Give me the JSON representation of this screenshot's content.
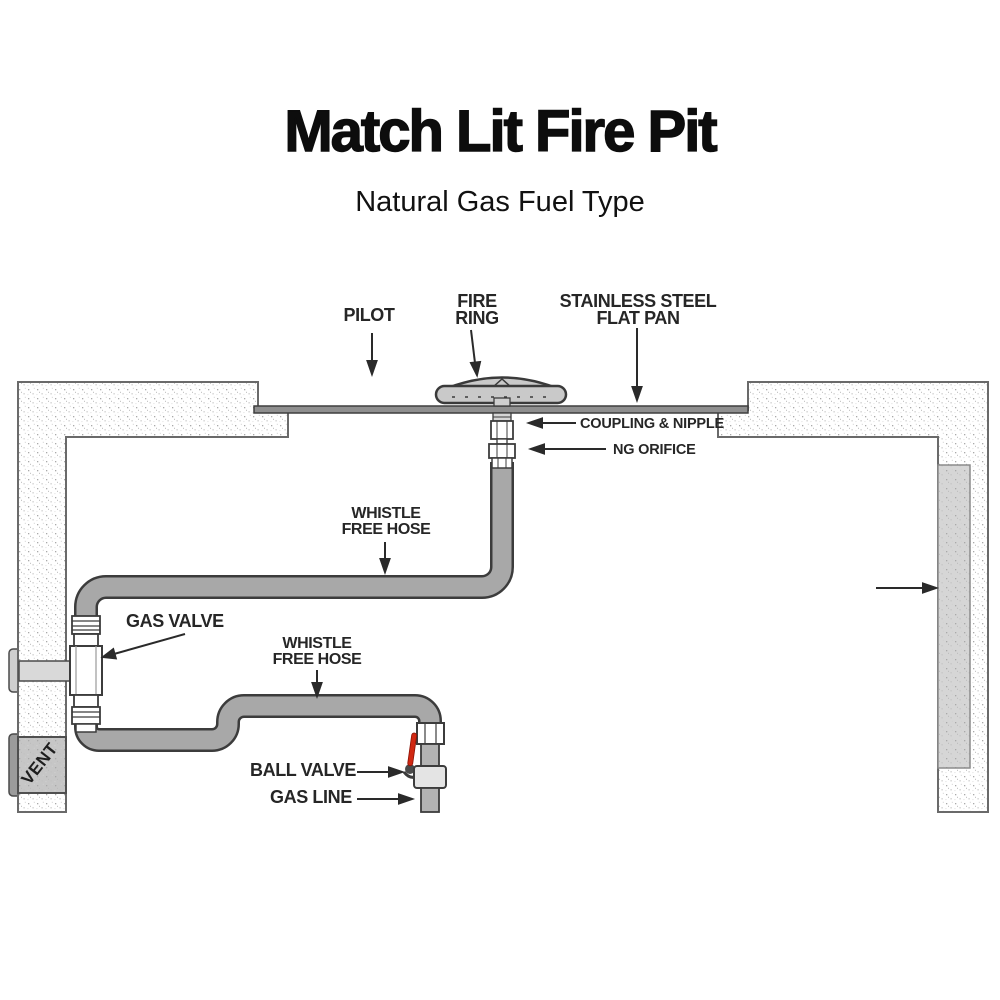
{
  "title": "Match Lit Fire Pit",
  "subtitle": "Natural Gas Fuel Type",
  "labels": {
    "pilot": "PILOT",
    "fire_ring": {
      "line1": "FIRE",
      "line2": "RING"
    },
    "flat_pan": {
      "line1": "STAINLESS STEEL",
      "line2": "FLAT PAN"
    },
    "coupling_nipple": "COUPLING & NIPPLE",
    "ng_orifice": "NG ORIFICE",
    "whistle_hose_upper": {
      "line1": "WHISTLE",
      "line2": "FREE HOSE"
    },
    "gas_valve": "GAS VALVE",
    "whistle_hose_lower": {
      "line1": "WHISTLE",
      "line2": "FREE HOSE"
    },
    "ball_valve": "BALL VALVE",
    "gas_line": "GAS LINE",
    "vent": "VENT"
  },
  "colors": {
    "hose_gray": "#a8a8a8",
    "pipe_gray": "#b3b3b3",
    "pan_gray": "#8f8f8f",
    "fire_ring_gray": "#c9c9c9",
    "valve_handle_red": "#d02812",
    "outline_dark": "#3c3c3c",
    "wall_outline": "#6a6a6a",
    "label_text": "#262626"
  }
}
